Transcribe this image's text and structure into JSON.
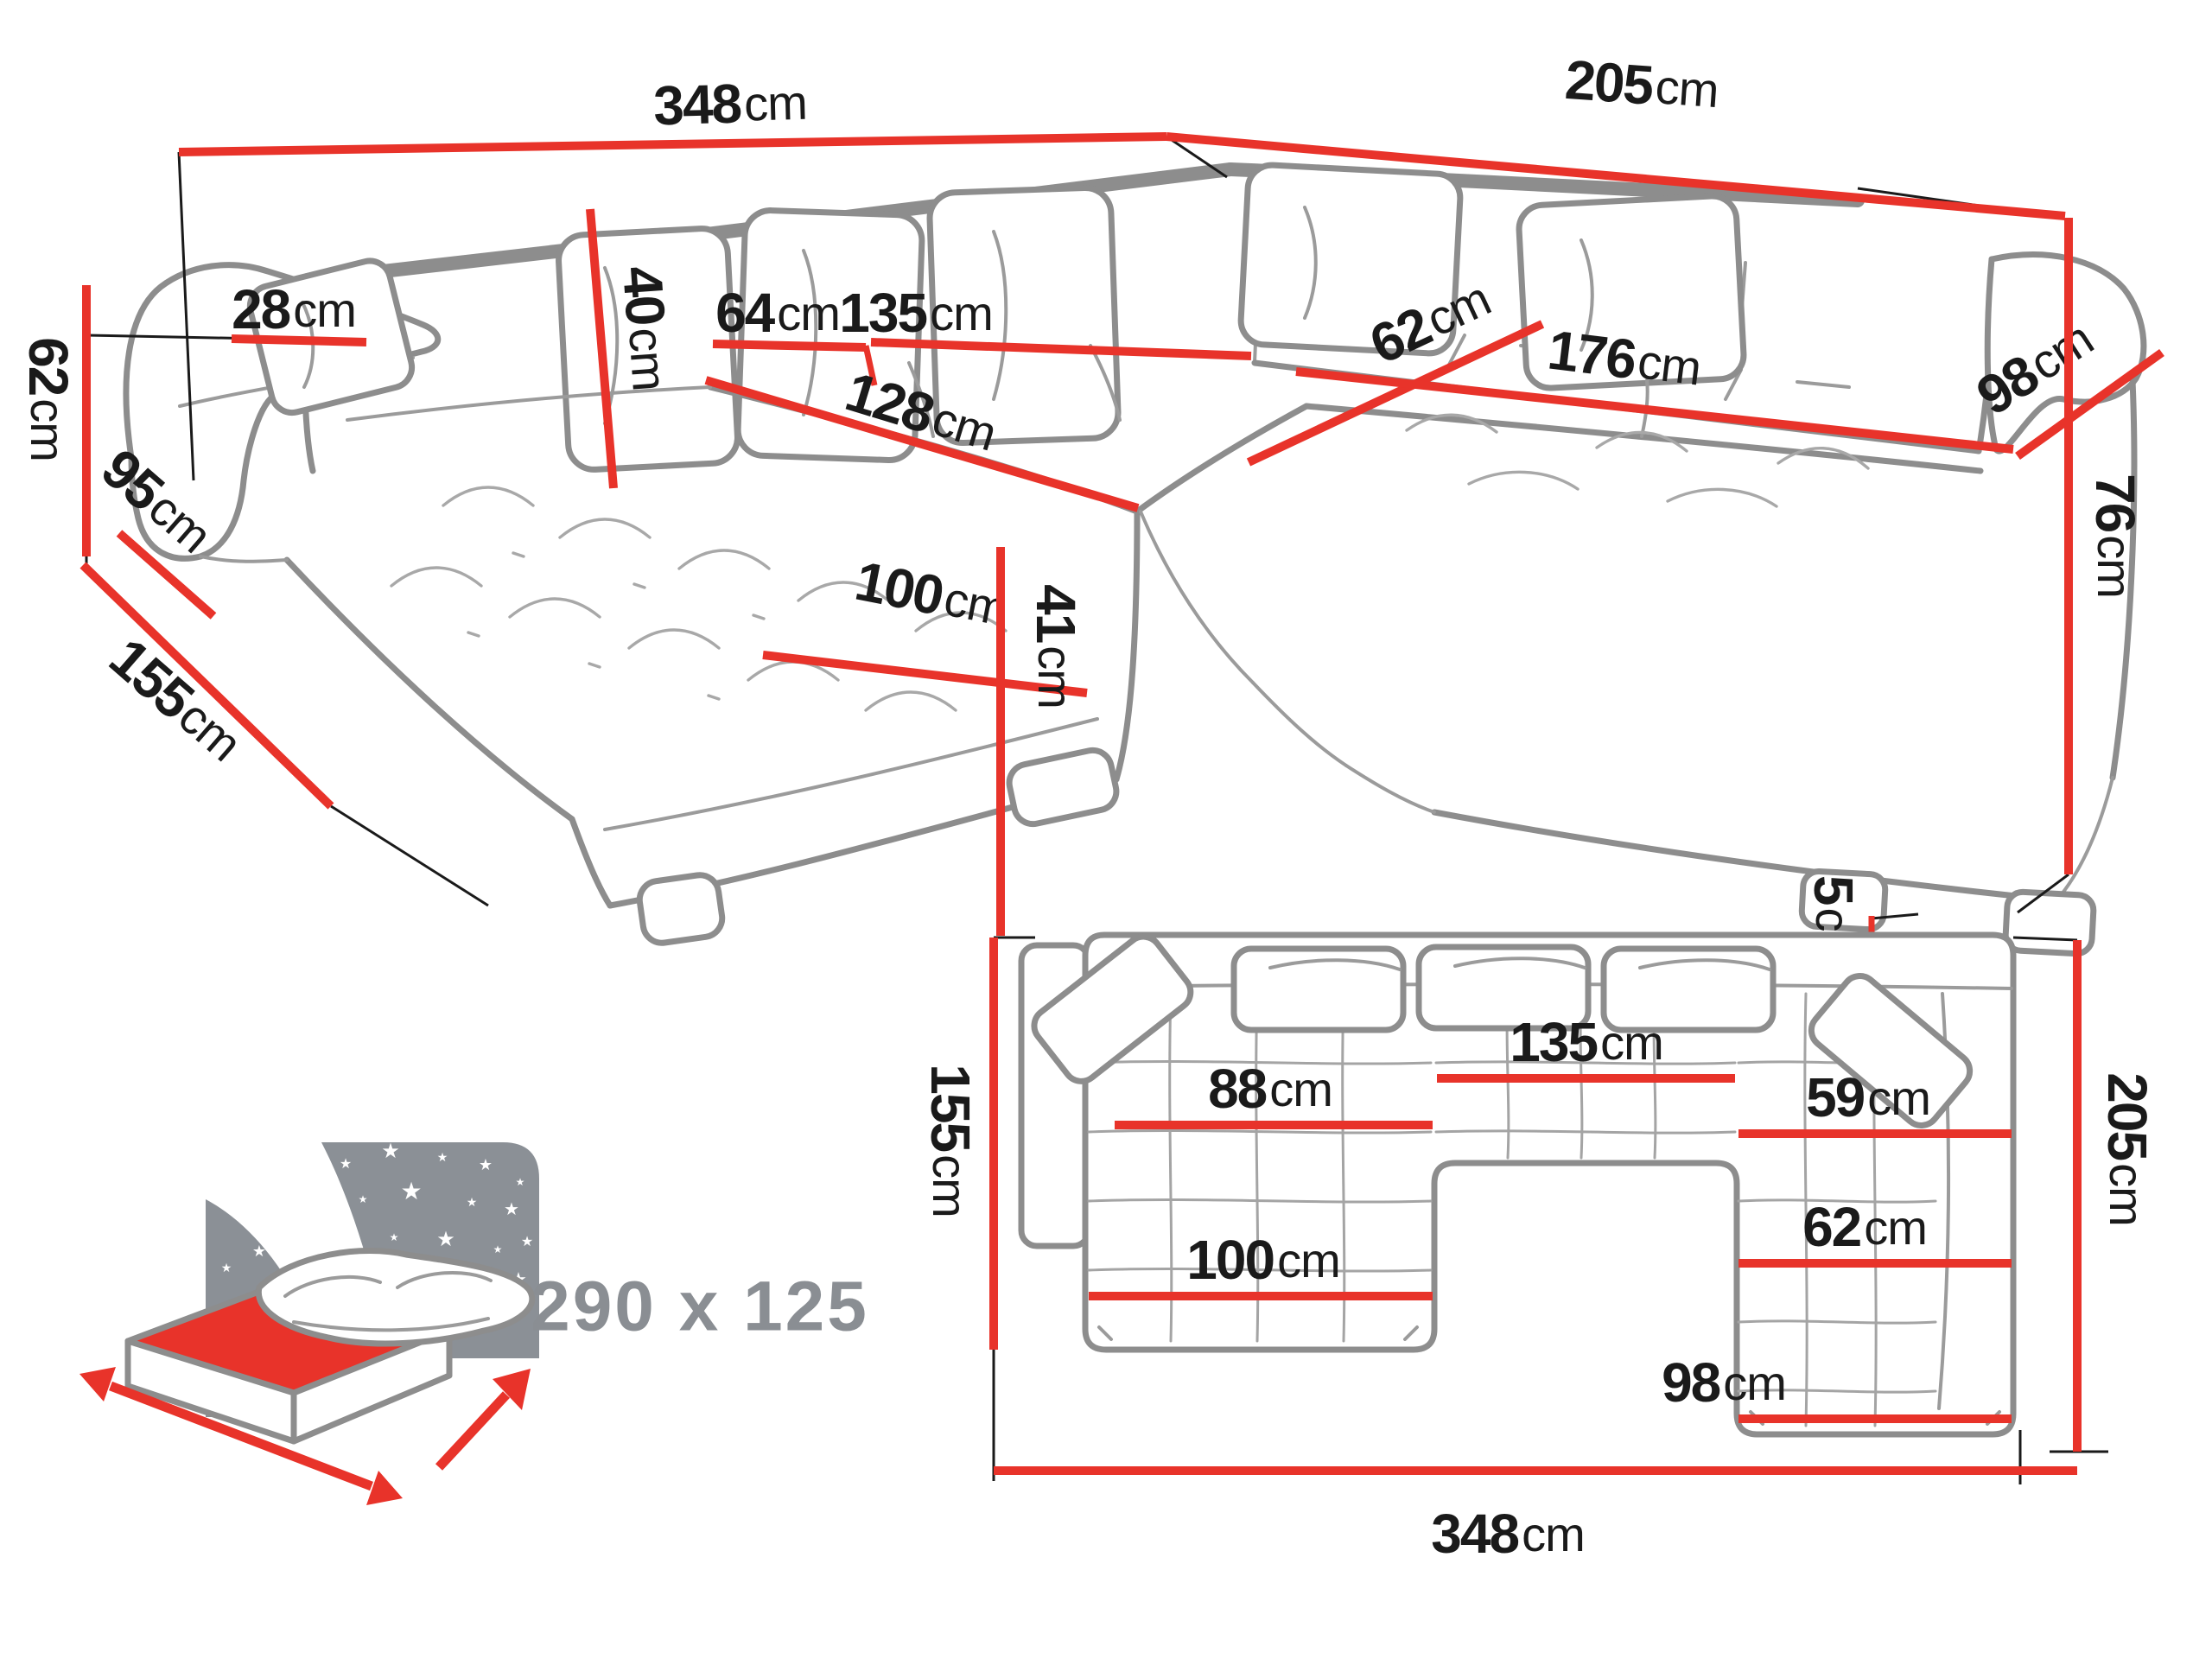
{
  "colors": {
    "dimension_red": "#e8332a",
    "outline_gray": "#8d8d8d",
    "label_black": "#1a1a1a",
    "icon_gray": "#8b9096",
    "sleep_text_gray": "#8a8e93"
  },
  "perspective_view": {
    "back_width": {
      "value": "348",
      "unit": "cm"
    },
    "right_side_width": {
      "value": "205",
      "unit": "cm"
    },
    "armrest_height": {
      "value": "62",
      "unit": "cm"
    },
    "chaise_total_depth": {
      "value": "155",
      "unit": "cm"
    },
    "armrest_depth": {
      "value": "95",
      "unit": "cm"
    },
    "armrest_top_width": {
      "value": "28",
      "unit": "cm"
    },
    "back_cushion_height": {
      "value": "40",
      "unit": "cm"
    },
    "seat_segment_width": {
      "value": "64",
      "unit": "cm"
    },
    "middle_seat_width": {
      "value": "135",
      "unit": "cm"
    },
    "chaise_seat_length": {
      "value": "128",
      "unit": "cm"
    },
    "chaise_seat_width": {
      "value": "100",
      "unit": "cm"
    },
    "seat_height": {
      "value": "41",
      "unit": "cm"
    },
    "corner_seat_depth": {
      "value": "62",
      "unit": "cm"
    },
    "right_seat_length": {
      "value": "176",
      "unit": "cm"
    },
    "right_seat_depth": {
      "value": "98",
      "unit": "cm"
    },
    "backrest_height": {
      "value": "76",
      "unit": "cm"
    },
    "leg_height": {
      "value": "5",
      "unit": "cm"
    }
  },
  "plan_view": {
    "chaise_depth": {
      "value": "155",
      "unit": "cm"
    },
    "chaise_seat_width_upper": {
      "value": "88",
      "unit": "cm"
    },
    "middle_seat_width": {
      "value": "135",
      "unit": "cm"
    },
    "right_seat_depth_upper": {
      "value": "59",
      "unit": "cm"
    },
    "right_seat_depth_lower": {
      "value": "62",
      "unit": "cm"
    },
    "chaise_seat_width_lower": {
      "value": "100",
      "unit": "cm"
    },
    "right_section_width": {
      "value": "98",
      "unit": "cm"
    },
    "total_width": {
      "value": "348",
      "unit": "cm"
    },
    "total_depth": {
      "value": "205",
      "unit": "cm"
    }
  },
  "sleeping_area": {
    "label": "290 x 125"
  }
}
